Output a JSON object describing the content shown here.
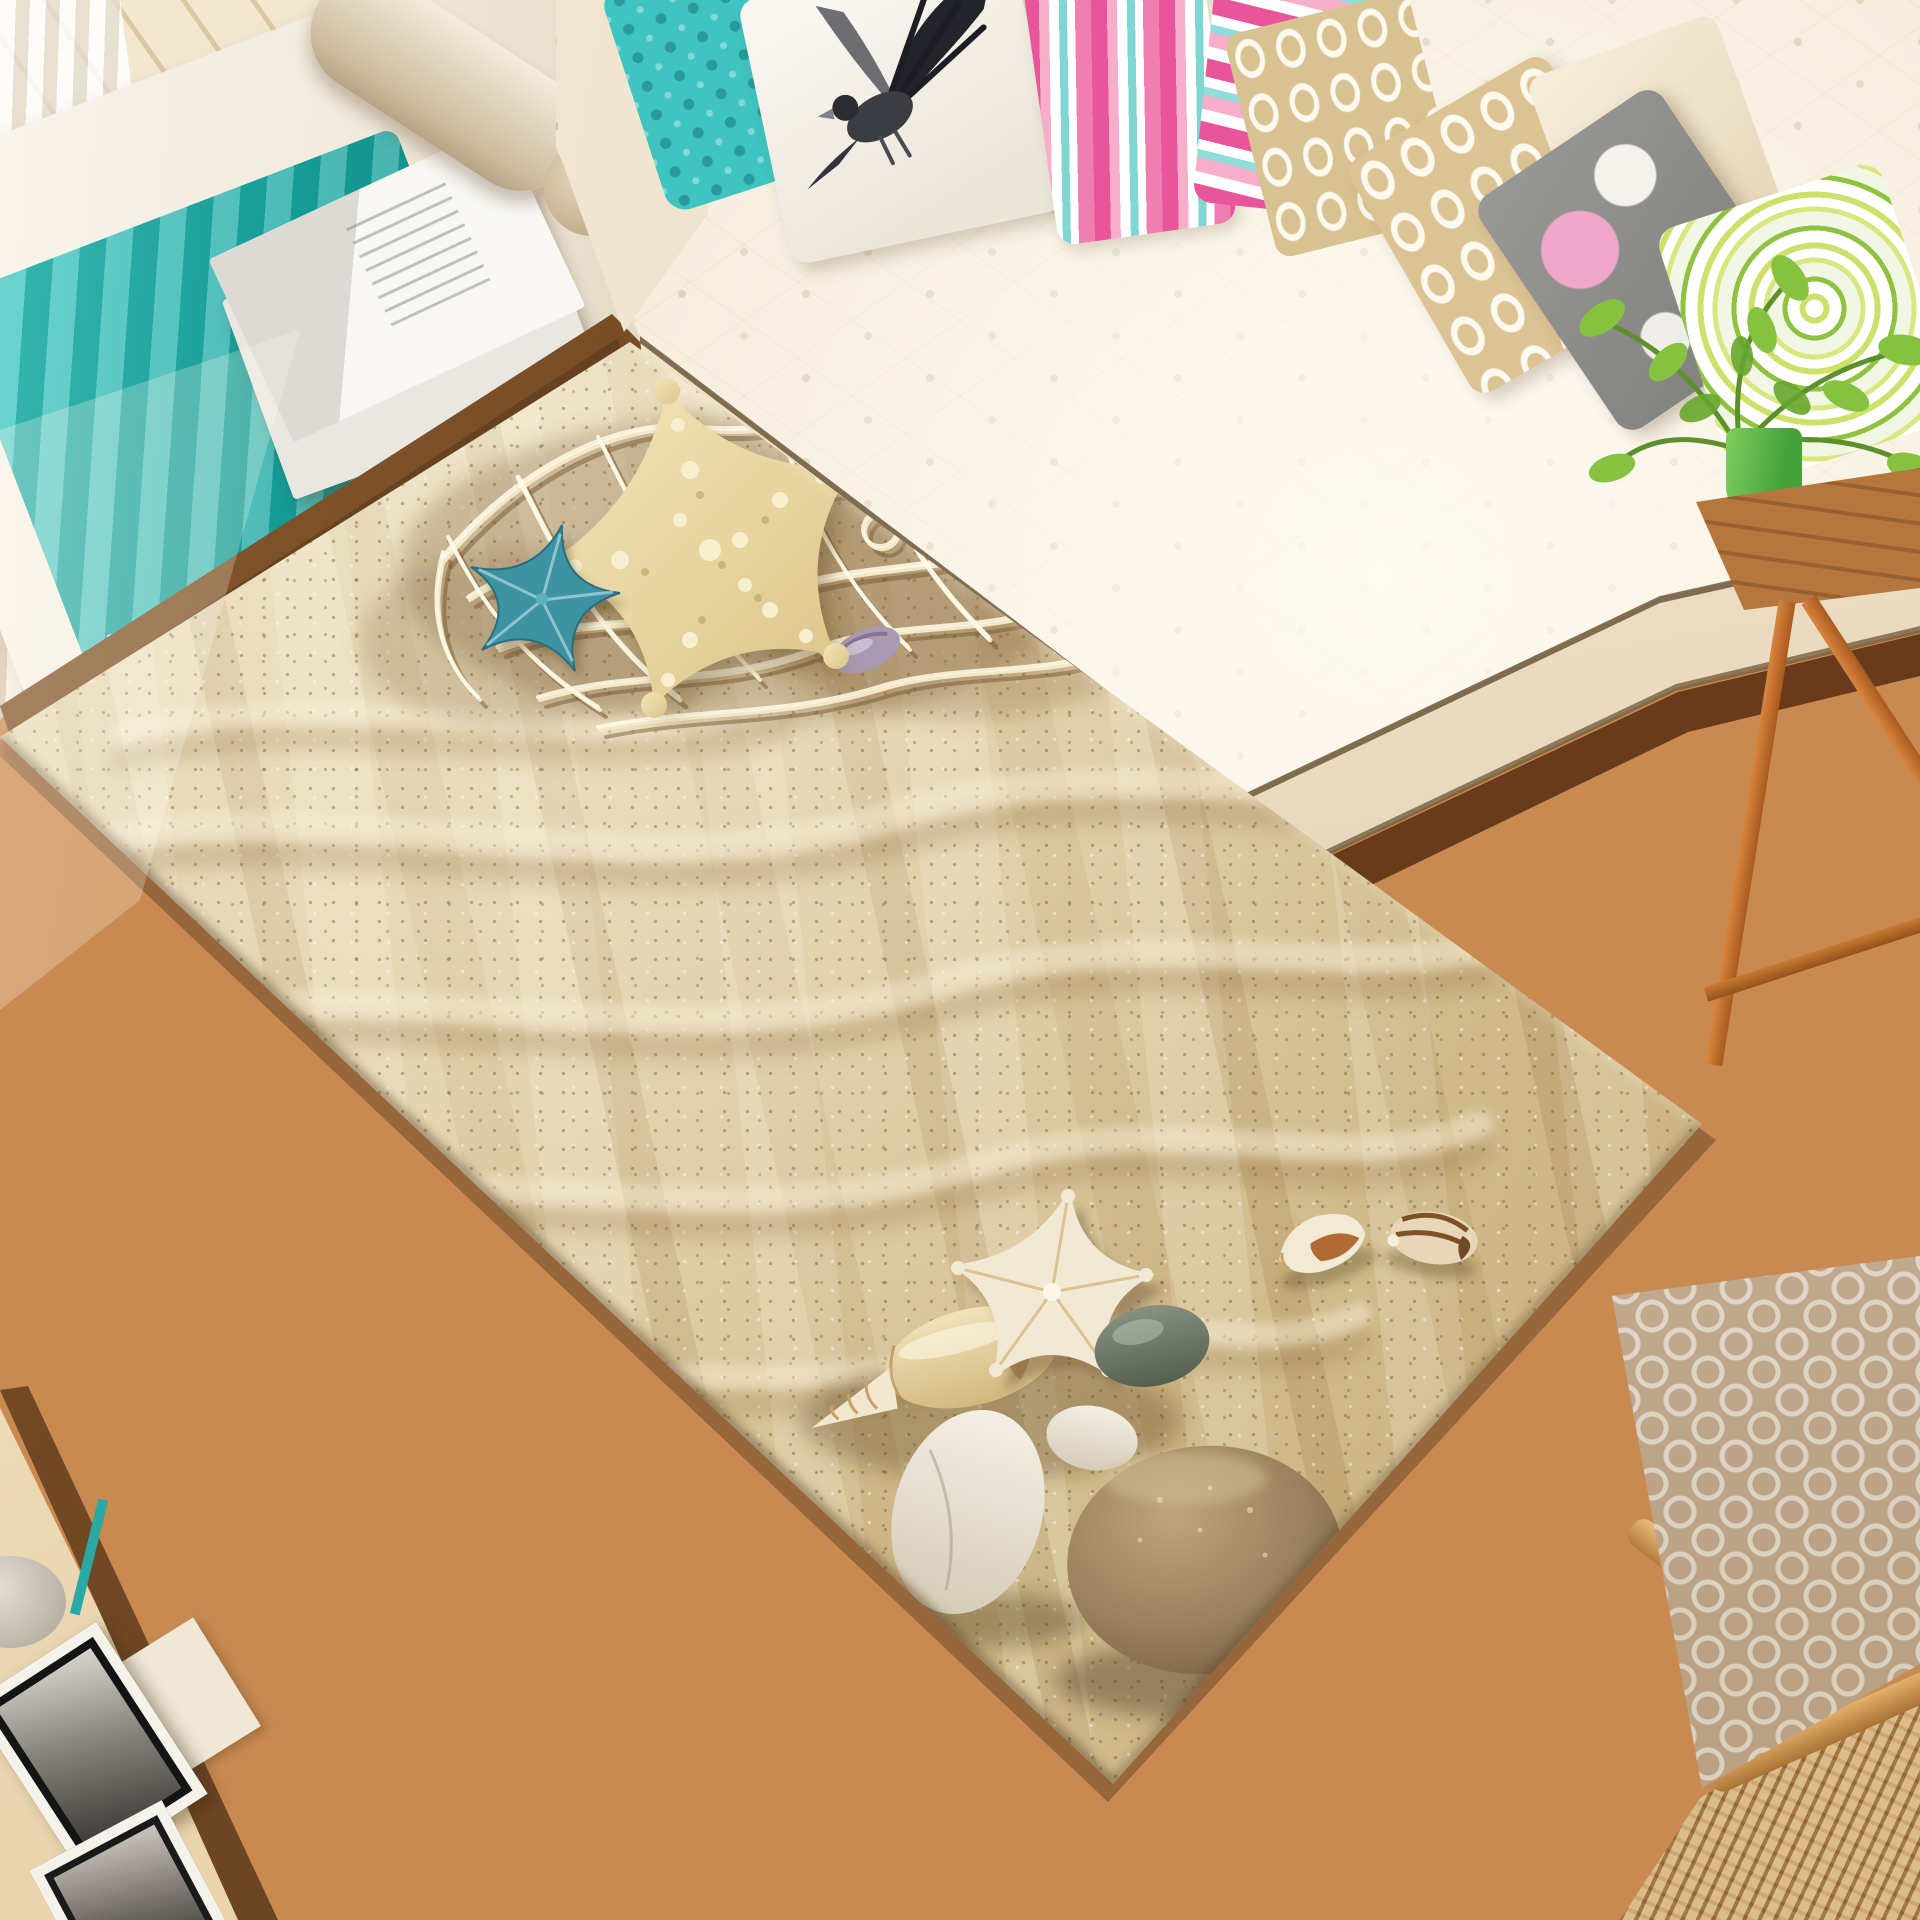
{
  "page": {
    "type": "natural-image",
    "subject": "Living room scene with a beach-sand 3D print area rug, cream tufted sofa, daybed with teal throw, and wooden floor"
  },
  "palette": {
    "floor_wood": "#c9874d",
    "walnut_trim": "#6b3f1f",
    "rug_sand_light": "#e7dab8",
    "rug_sand_dark": "#b99a66",
    "fishing_net": "#f2e7c6",
    "starfish_cream": "#ecd9a4",
    "starfish_blue": "#3e93a3",
    "starfish_white": "#f2e9d4",
    "stone_gray": "#5a6553",
    "stone_brown": "#98805c",
    "stone_white": "#f4efe4",
    "sofa_cream": "#f2e7d4",
    "throw_teal": "#1fa8a3",
    "pillow_pink": "#e8559b",
    "pillow_teal": "#3fc4c1",
    "pillow_lattice": "#d9c291",
    "pillow_swirl_green": "#8fc23f",
    "plant_green": "#86c23f",
    "pot_green": "#62c04c",
    "copper_legs": "#c47a33",
    "stool_cushion": "#d8c3ab",
    "oak_frame": "#dba968",
    "curtain_white": "#f6f2ea",
    "window_frame_black": "#26282e"
  },
  "objects": [
    {
      "name": "area-rug-beach-print",
      "color": "#d7c498"
    },
    {
      "name": "fishing-net-motif",
      "color": "#f2e7c6"
    },
    {
      "name": "large-cream-starfish",
      "color": "#ecd9a4"
    },
    {
      "name": "small-blue-starfish",
      "color": "#3e93a3"
    },
    {
      "name": "small-white-starfish",
      "color": "#f2e9d4"
    },
    {
      "name": "conch-shell",
      "color": "#eddcae"
    },
    {
      "name": "spiral-shell-white",
      "color": "#f2e9d6"
    },
    {
      "name": "spiral-shell-brown",
      "color": "#e7d6b8"
    },
    {
      "name": "purple-shell",
      "color": "#a89ab2"
    },
    {
      "name": "gray-pebble",
      "color": "#5a6553"
    },
    {
      "name": "white-stone",
      "color": "#f4efe4"
    },
    {
      "name": "brown-stone",
      "color": "#98805c"
    },
    {
      "name": "tufted-sofa",
      "color": "#f2e7d4"
    },
    {
      "name": "daybed-bench",
      "color": "#f6f2ea"
    },
    {
      "name": "teal-throw-blanket",
      "color": "#1fa8a3"
    },
    {
      "name": "magazines",
      "color": "#f6f5f1"
    },
    {
      "name": "bird-print-pillow",
      "color": "#f7f4ee"
    },
    {
      "name": "teal-pattern-pillow",
      "color": "#3fc4c1"
    },
    {
      "name": "pink-striped-pillows",
      "color": "#e8559b"
    },
    {
      "name": "lattice-pillows",
      "color": "#d9c291"
    },
    {
      "name": "floral-gray-pink-pillow",
      "color": "#9a9a98"
    },
    {
      "name": "green-swirl-pillow",
      "color": "#8fc23f"
    },
    {
      "name": "potted-plant",
      "color": "#86c23f"
    },
    {
      "name": "copper-leg-side-table",
      "color": "#c47a33"
    },
    {
      "name": "patterned-stool",
      "color": "#d8c3ab"
    },
    {
      "name": "rattan-bench-corner",
      "color": "#c99c5d"
    },
    {
      "name": "photo-frames",
      "color": "#111111"
    },
    {
      "name": "window-black-frame",
      "color": "#26282e"
    },
    {
      "name": "sheer-curtains",
      "color": "#f6f2ea"
    },
    {
      "name": "wood-plank-floor",
      "color": "#c9874d"
    }
  ]
}
